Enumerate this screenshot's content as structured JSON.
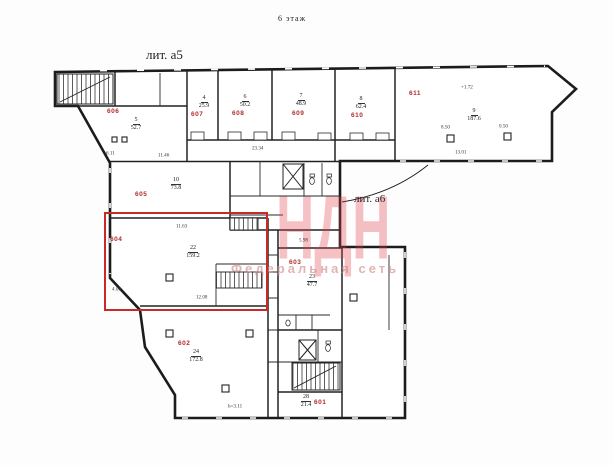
{
  "titles": {
    "floor": "6 этаж",
    "lit_a5": "лит. а5",
    "lit_a6": "лит. а6"
  },
  "watermark": {
    "big": "НДН",
    "sub": "Федеральная сеть"
  },
  "highlight": {
    "room": "604",
    "color": "#c92a28"
  },
  "rooms": [
    {
      "id": "601",
      "id_x": 314,
      "id_y": 399,
      "num": "28",
      "area": "21.4",
      "cx": 286,
      "cy": 394
    },
    {
      "id": "602",
      "id_x": 178,
      "id_y": 340,
      "num": "24",
      "area": "172.8",
      "cx": 176,
      "cy": 349
    },
    {
      "id": "603",
      "id_x": 289,
      "id_y": 259,
      "num": "23",
      "area": "47.7",
      "cx": 292,
      "cy": 274
    },
    {
      "id": "604",
      "id_x": 110,
      "id_y": 236,
      "num": "22",
      "area": "159.2",
      "cx": 173,
      "cy": 245
    },
    {
      "id": "605",
      "id_x": 135,
      "id_y": 191,
      "num": "10",
      "area": "73.8",
      "cx": 156,
      "cy": 177
    },
    {
      "id": "606",
      "id_x": 107,
      "id_y": 108,
      "num": "5",
      "area": "52.7",
      "cx": 116,
      "cy": 117
    },
    {
      "id": "607",
      "id_x": 191,
      "id_y": 111,
      "num": "4",
      "area": "25.9",
      "cx": 184,
      "cy": 95
    },
    {
      "id": "608",
      "id_x": 232,
      "id_y": 110,
      "num": "6",
      "area": "50.2",
      "cx": 225,
      "cy": 94
    },
    {
      "id": "609",
      "id_x": 292,
      "id_y": 110,
      "num": "7",
      "area": "48.9",
      "cx": 281,
      "cy": 93
    },
    {
      "id": "610",
      "id_x": 351,
      "id_y": 112,
      "num": "8",
      "area": "62.4",
      "cx": 341,
      "cy": 96
    },
    {
      "id": "611",
      "id_x": 409,
      "id_y": 90,
      "num": "9",
      "area": "187.6",
      "cx": 454,
      "cy": 108
    }
  ],
  "dimensions": [
    {
      "text": "11.63",
      "x": 176,
      "y": 224
    },
    {
      "text": "12.08",
      "x": 196,
      "y": 295
    },
    {
      "text": "13.01",
      "x": 455,
      "y": 150
    },
    {
      "text": "23.34",
      "x": 252,
      "y": 146
    },
    {
      "text": "h=3.11",
      "x": 228,
      "y": 404
    },
    {
      "text": "5.98",
      "x": 299,
      "y": 238
    },
    {
      "text": "11.46",
      "x": 158,
      "y": 153
    },
    {
      "text": "6.11",
      "x": 106,
      "y": 151
    },
    {
      "text": "8.50",
      "x": 441,
      "y": 125
    },
    {
      "text": "0.50",
      "x": 499,
      "y": 124
    },
    {
      "text": "+1.72",
      "x": 461,
      "y": 85
    },
    {
      "text": "4.09",
      "x": 112,
      "y": 287
    }
  ],
  "colors": {
    "wall": "#1c1c1c",
    "room_label": "#b22a2a",
    "highlight": "#c92a28",
    "watermark": "#e43e46"
  }
}
